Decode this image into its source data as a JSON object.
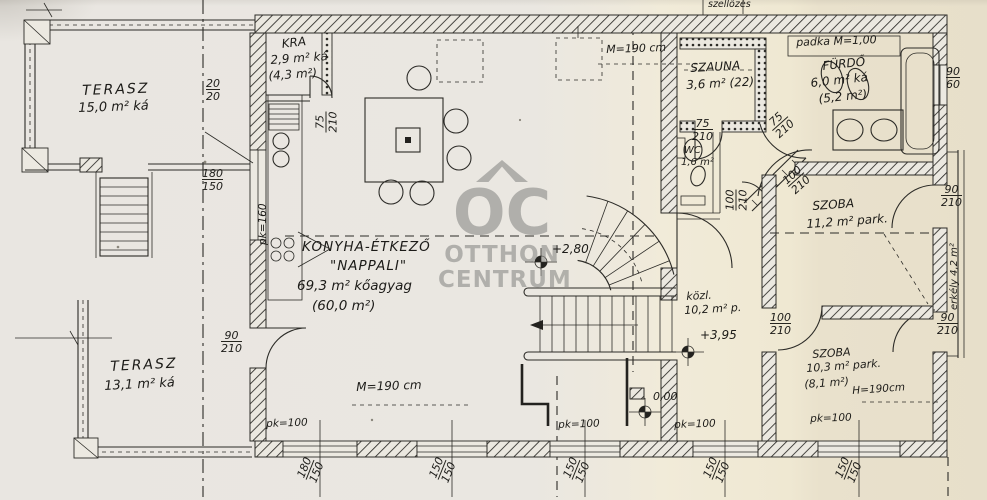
{
  "watermark": {
    "abbr": "OC",
    "line1": "OTTHON",
    "line2": "CENTRUM",
    "color": "#8e8e8b"
  },
  "rooms": {
    "terasz1": {
      "name": "TERASZ",
      "area": "15,0 m² ká"
    },
    "kamra": {
      "name": "KRA",
      "area": "2,9 m² ká",
      "alt": "(4,3 m²)"
    },
    "nappali": {
      "l1": "KONYHA-ÉTKEZŐ",
      "l2": "\"NAPPALI\"",
      "l3": "69,3 m² kőagyag",
      "l4": "(60,0 m²)"
    },
    "szauna": {
      "name": "SZAUNA",
      "area": "3,6 m² (22)"
    },
    "furdo": {
      "name": "FÜRDŐ",
      "area": "6,0 m² ká",
      "alt": "(5,2 m²)"
    },
    "wc": {
      "name": "WC",
      "area": "1,6 m²"
    },
    "szoba1": {
      "name": "SZOBA",
      "area": "11,2 m² park."
    },
    "kozlekedo": {
      "name": "közl.",
      "area": "10,2 m² p."
    },
    "szoba2": {
      "name": "SZOBA",
      "area": "10,3 m² park.",
      "alt": "(8,1 m²)",
      "height": "H=190cm"
    },
    "terasz2": {
      "name": "TERASZ",
      "area": "13,1 m² ká"
    },
    "erkely": {
      "label": "erkély 4,2 m²"
    }
  },
  "annotations": {
    "padka": "padka M=1,00",
    "szellozes": "szellőzés",
    "height_top": "M=190 cm",
    "height_bottom": "M=190 cm",
    "elev_living": "+2,80",
    "elev_upper": "+3,95",
    "elev_ground": "0,00"
  },
  "parapet_labels": [
    "pk=100",
    "pk=100",
    "pk=100",
    "pk=100",
    "pk=160"
  ],
  "dimensions": [
    {
      "w": "20",
      "h": "20"
    },
    {
      "w": "180",
      "h": "150"
    },
    {
      "w": "90",
      "h": "210"
    },
    {
      "w": "75",
      "h": "210"
    },
    {
      "w": "75",
      "h": "210"
    },
    {
      "w": "75",
      "h": "210"
    },
    {
      "w": "100",
      "h": "210"
    },
    {
      "w": "100",
      "h": "210"
    },
    {
      "w": "100",
      "h": "210"
    },
    {
      "w": "90",
      "h": "210"
    },
    {
      "w": "90",
      "h": "210"
    },
    {
      "w": "90",
      "h": "60"
    },
    {
      "w": "180",
      "h": "150"
    },
    {
      "w": "150",
      "h": "150"
    },
    {
      "w": "150",
      "h": "150"
    },
    {
      "w": "150",
      "h": "150"
    },
    {
      "w": "150",
      "h": "150"
    }
  ]
}
